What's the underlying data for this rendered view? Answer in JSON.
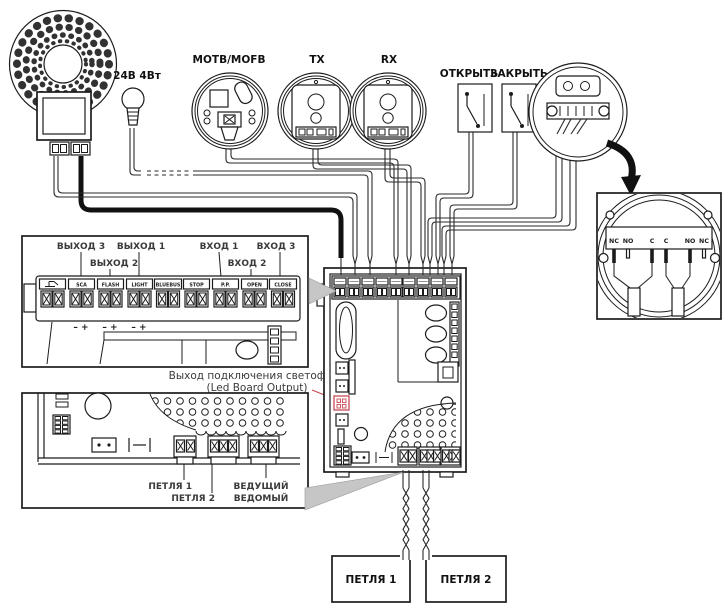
{
  "devices": {
    "lamp": "24В 4Вт",
    "photocell_cmd": "MOTB/MOFB",
    "photocell_tx": "TX",
    "photocell_rx": "RX",
    "switch_open": "ОТКРЫТЬ",
    "switch_close": "ЗАКРЫТЬ"
  },
  "selector_detail": {
    "terminals": [
      "NC",
      "NO",
      "C",
      "C",
      "NO",
      "NC"
    ]
  },
  "terminal_block": {
    "io_labels": [
      "ВЫХОД 3",
      "ВЫХОД 2",
      "ВЫХОД 1",
      "ВХОД 1",
      "ВХОД 2",
      "ВХОД 3"
    ],
    "names": [
      "SCA",
      "FLASH",
      "LIGHT",
      "BLUEBUS",
      "STOP",
      "P.P.",
      "OPEN",
      "CLOSE"
    ],
    "polarity": "–  +"
  },
  "led_note": {
    "line1": "Выход подключения светофора",
    "line2": "(Led Board Output)"
  },
  "board_bottom": {
    "loop1": "ПЕТЛЯ 1",
    "loop2": "ПЕТЛЯ 2",
    "master": "ВЕДУЩИЙ",
    "slave": "ВЕДОМЫЙ"
  },
  "loops": {
    "box1": "ПЕТЛЯ 1",
    "box2": "ПЕТЛЯ 2"
  },
  "colors": {
    "line": "#1c1c1c",
    "accent_red": "#c94a57",
    "arrow_gray": "#c6c6c6"
  }
}
